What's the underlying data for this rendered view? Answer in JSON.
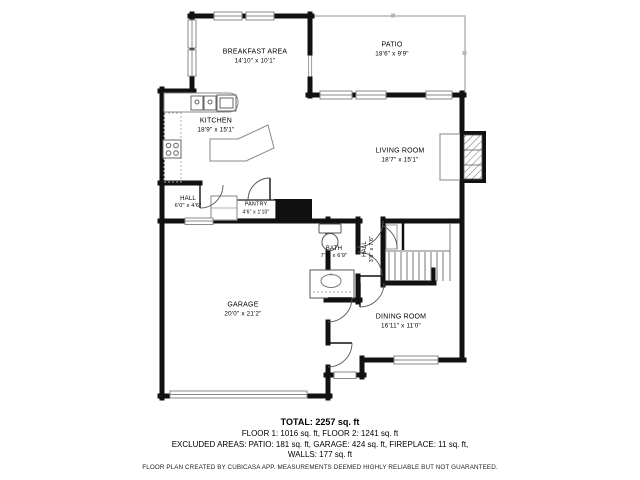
{
  "floorplan": {
    "rooms": [
      {
        "name": "BREAKFAST AREA",
        "dims": "14'10\" x 10'1\""
      },
      {
        "name": "PATIO",
        "dims": "18'6\" x 9'9\""
      },
      {
        "name": "KITCHEN",
        "dims": "18'9\" x 15'1\""
      },
      {
        "name": "LIVING ROOM",
        "dims": "18'7\" x 15'1\""
      },
      {
        "name": "HALL",
        "dims": "6'0\" x 4'6\""
      },
      {
        "name": "PANTRY",
        "dims": "4'6\" x 1'10\""
      },
      {
        "name": "BATH",
        "dims": "7'1\" x 6'9\""
      },
      {
        "name": "HALL",
        "dims": "3'8\" x 7'6\""
      },
      {
        "name": "GARAGE",
        "dims": "20'0\" x 21'2\""
      },
      {
        "name": "DINING ROOM",
        "dims": "16'11\" x 11'0\""
      }
    ],
    "summary": {
      "total": "TOTAL: 2257 sq. ft",
      "floors": "FLOOR 1: 1016 sq. ft, FLOOR 2: 1241 sq. ft",
      "excluded": "EXCLUDED AREAS: PATIO: 181 sq. ft, GARAGE: 424 sq. ft, FIREPLACE: 11 sq. ft,",
      "walls": "WALLS: 177 sq. ft",
      "disclaimer": "FLOOR PLAN CREATED BY CUBICASA APP. MEASUREMENTS DEEMED HIGHLY RELIABLE BUT NOT GUARANTEED."
    },
    "colors": {
      "wall": "#111111",
      "thin_line": "#b5b5b5",
      "fixture": "#777777"
    }
  }
}
